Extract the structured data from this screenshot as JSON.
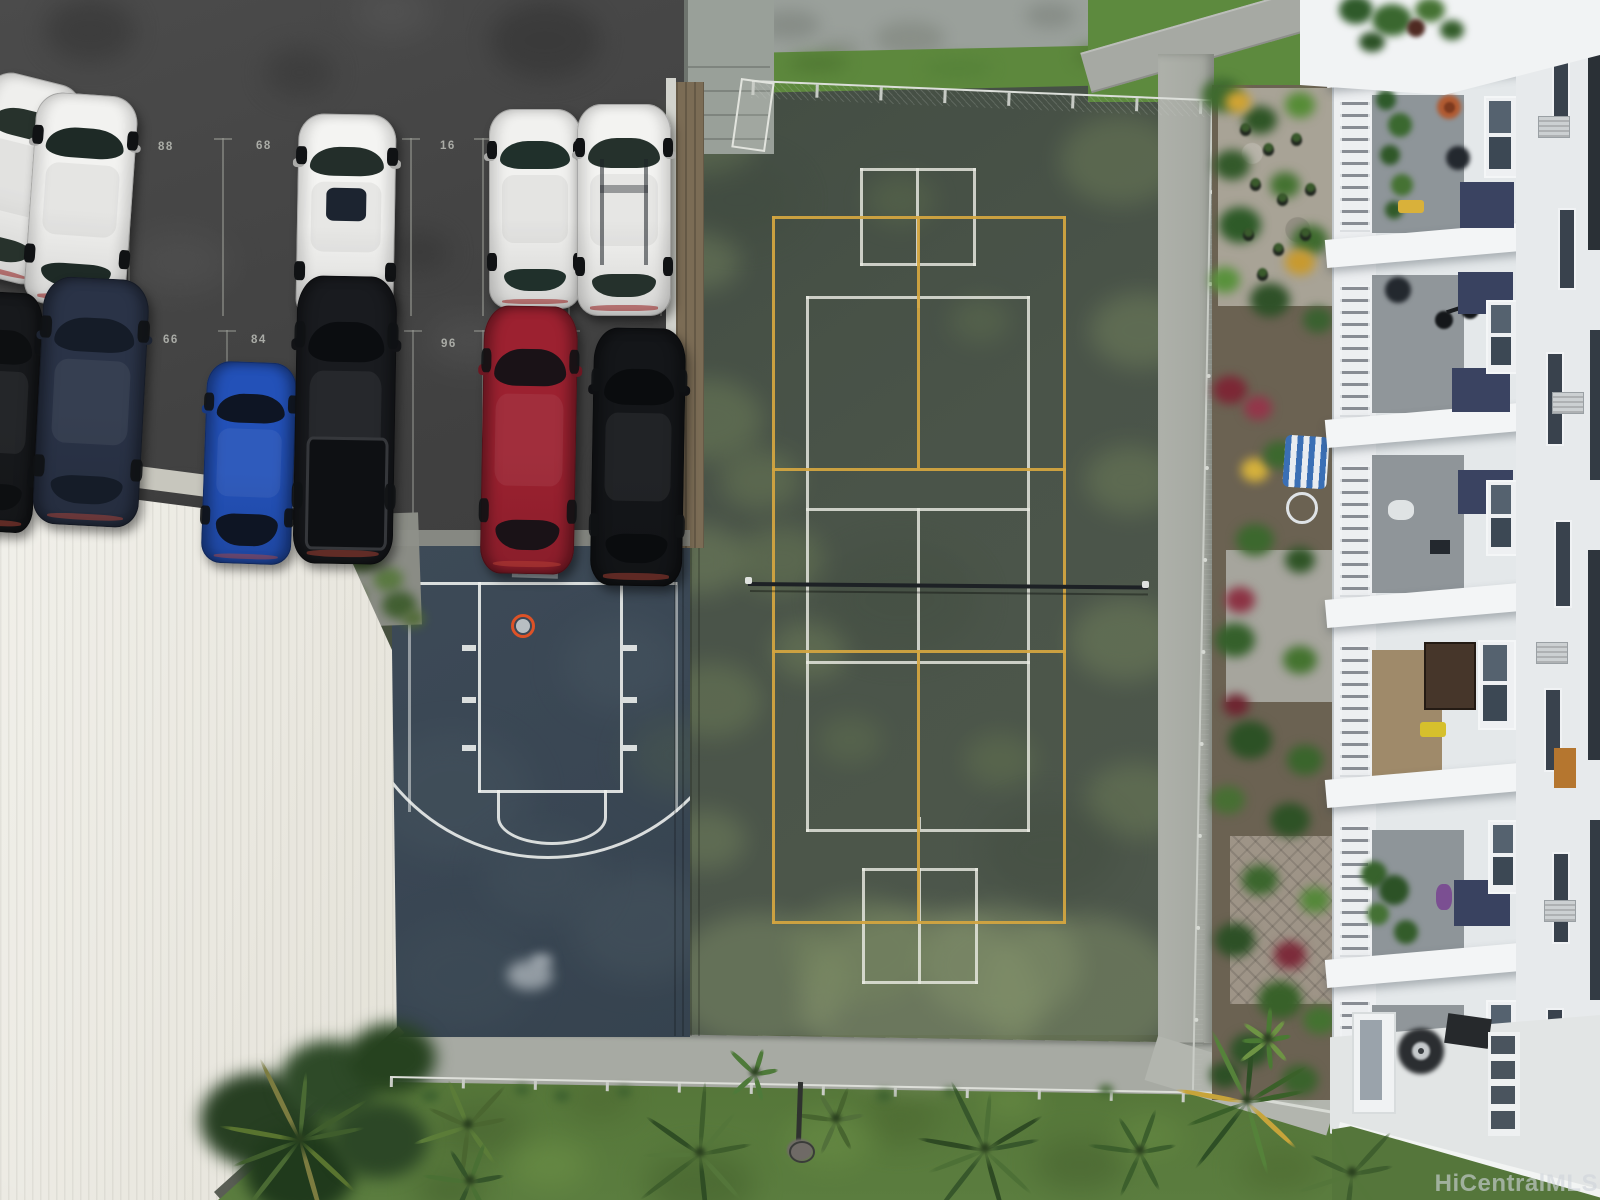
{
  "meta": {
    "kind": "aerial-drone-photo",
    "subject": "condo amenity deck with parking, courts, garden, building, lawn"
  },
  "watermark": {
    "text": "HiCentralMLS",
    "color": "rgba(206,212,218,0.62)"
  },
  "parking_lot": {
    "asphalt_color": "#464646",
    "stall_numbers": [
      {
        "label": "88",
        "x": 158,
        "y": 141
      },
      {
        "label": "68",
        "x": 256,
        "y": 140
      },
      {
        "label": "16",
        "x": 440,
        "y": 140
      },
      {
        "label": "66",
        "x": 163,
        "y": 334
      },
      {
        "label": "84",
        "x": 251,
        "y": 334
      },
      {
        "label": "96",
        "x": 441,
        "y": 338
      }
    ],
    "cars": [
      {
        "name": "white-coupe-partial",
        "type": "sedan",
        "x": -34,
        "y": 76,
        "w": 98,
        "h": 204,
        "rot": 14,
        "body": "#efefed",
        "glass": "#27322c"
      },
      {
        "name": "white-sedan",
        "type": "sedan",
        "x": 30,
        "y": 94,
        "w": 102,
        "h": 212,
        "rot": 4,
        "body": "#f2f2f0",
        "glass": "#1e2a26"
      },
      {
        "name": "white-suv-sunroof",
        "type": "suv",
        "x": 297,
        "y": 114,
        "w": 98,
        "h": 206,
        "rot": 1,
        "body": "#f4f4f2",
        "glass": "#232e2a"
      },
      {
        "name": "white-sedan-2",
        "type": "sedan",
        "x": 489,
        "y": 109,
        "w": 92,
        "h": 200,
        "rot": 0,
        "body": "#f1f1ef",
        "glass": "#20302b"
      },
      {
        "name": "white-wagon-roofrack",
        "type": "wagon",
        "x": 577,
        "y": 104,
        "w": 94,
        "h": 212,
        "rot": 0,
        "body": "#f3f3f1",
        "glass": "#25312c"
      },
      {
        "name": "black-car-partial",
        "type": "sedan",
        "x": -38,
        "y": 292,
        "w": 76,
        "h": 240,
        "rot": 3,
        "body": "#17191c",
        "glass": "#0d0f11"
      },
      {
        "name": "navy-sedan",
        "type": "sedan",
        "x": 38,
        "y": 278,
        "w": 106,
        "h": 248,
        "rot": 3,
        "body": "#2a3347",
        "glass": "#151c28"
      },
      {
        "name": "blue-hatchback",
        "type": "hatch",
        "x": 204,
        "y": 362,
        "w": 90,
        "h": 202,
        "rot": 2,
        "body": "#2351b8",
        "glass": "#0e1524"
      },
      {
        "name": "black-pickup",
        "type": "pickup",
        "x": 295,
        "y": 276,
        "w": 100,
        "h": 288,
        "rot": 1,
        "body": "#191b1f",
        "glass": "#0b0d10"
      },
      {
        "name": "red-sedan",
        "type": "sedan",
        "x": 482,
        "y": 306,
        "w": 94,
        "h": 268,
        "rot": 1,
        "body": "#9c2130",
        "glass": "#1a1217"
      },
      {
        "name": "black-sedan",
        "type": "sedan",
        "x": 592,
        "y": 328,
        "w": 92,
        "h": 258,
        "rot": 1,
        "body": "#141619",
        "glass": "#0a0c0e"
      }
    ]
  },
  "basketball_court": {
    "surface": "#3a4754",
    "line_color": "rgba(240,242,240,0.88)",
    "hoop_color": "#dd5227"
  },
  "tennis_court": {
    "surface": "#4a5449",
    "line_color": "#e9eae2",
    "pickleball_line_color": "#d2a440",
    "net_color": "#1d2125"
  },
  "building": {
    "wall": "#e4e8ea",
    "bright_band": "#f3f5f6",
    "accent_panel": "#3a4361",
    "balcony_floor": "#8e9599",
    "tan_floor": "#9f8a6a"
  },
  "landscape": {
    "lawn": "#57793c",
    "grass_strip": "#5d883d",
    "walkway": "#a9aca5",
    "roof": "#ece9e1",
    "soil": "#6b6252"
  }
}
